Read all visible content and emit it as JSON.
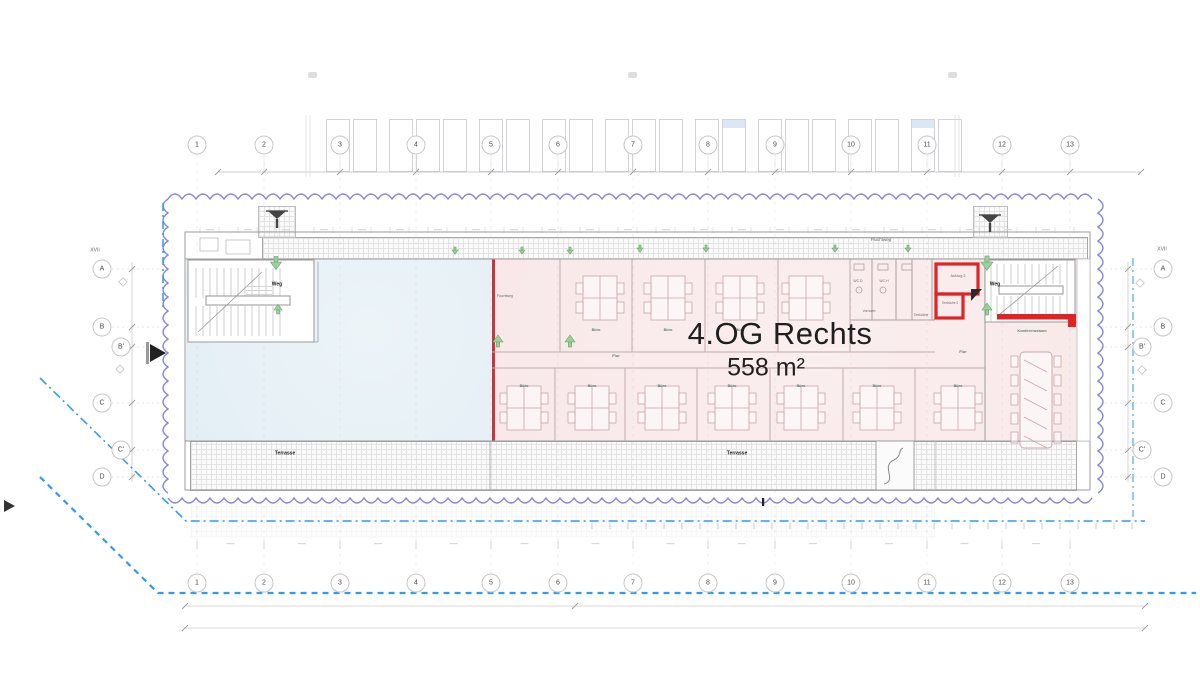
{
  "title": {
    "main": "4.OG Rechts",
    "area": "558 m²"
  },
  "grid": {
    "columns": [
      "1",
      "2",
      "3",
      "4",
      "5",
      "6",
      "7",
      "8",
      "9",
      "10",
      "11",
      "12",
      "13"
    ],
    "rows": [
      {
        "label": "A",
        "y": 269,
        "offset": false
      },
      {
        "label": "B",
        "y": 327,
        "offset": false
      },
      {
        "label": "B'",
        "y": 347,
        "offset": true
      },
      {
        "label": "C",
        "y": 403,
        "offset": false
      },
      {
        "label": "C'",
        "y": 450,
        "offset": true
      },
      {
        "label": "D",
        "y": 477,
        "offset": false
      }
    ],
    "section_label": "XVII"
  },
  "units": {
    "highlighted": {
      "name": "4.OG Rechts",
      "area": "558 m²"
    },
    "other": {
      "name": ""
    }
  },
  "room_labels": [
    {
      "t": "XVII",
      "x": 95,
      "y": 250,
      "s": 5,
      "c": "lg"
    },
    {
      "t": "XVII",
      "x": 1162,
      "y": 249,
      "s": 5,
      "c": "lg"
    },
    {
      "t": "Weg",
      "x": 277,
      "y": 284,
      "s": 5,
      "c": "lb"
    },
    {
      "t": "Weg",
      "x": 995,
      "y": 284,
      "s": 5,
      "c": "lb"
    },
    {
      "t": "Fluchtweg",
      "x": 881,
      "y": 240,
      "s": 4.5,
      "c": "lg"
    },
    {
      "t": "Fluchtweg",
      "x": 505,
      "y": 296,
      "s": 3.5,
      "c": "lg"
    },
    {
      "t": "Aufzug 2",
      "x": 958,
      "y": 276,
      "s": 3.8,
      "c": "lg"
    },
    {
      "t": "Teeküche 2",
      "x": 950,
      "y": 303,
      "s": 3.2,
      "c": "lg"
    },
    {
      "t": "Teeküche",
      "x": 921,
      "y": 315,
      "s": 3.4,
      "c": "lg"
    },
    {
      "t": "Vorraum",
      "x": 869,
      "y": 311,
      "s": 3.4,
      "c": "lg"
    },
    {
      "t": "WC-D",
      "x": 858,
      "y": 281,
      "s": 3.4,
      "c": "lg"
    },
    {
      "t": "WC-H",
      "x": 884,
      "y": 281,
      "s": 3.4,
      "c": "lg"
    },
    {
      "t": "Flur",
      "x": 616,
      "y": 356,
      "s": 4,
      "c": "lt"
    },
    {
      "t": "Flur",
      "x": 963,
      "y": 352,
      "s": 4,
      "c": "lt"
    },
    {
      "t": "Konferenzraum",
      "x": 1032,
      "y": 331,
      "s": 4,
      "c": "lt"
    },
    {
      "t": "Terrasse",
      "x": 285,
      "y": 453,
      "s": 5,
      "c": "lb"
    },
    {
      "t": "Terrasse",
      "x": 737,
      "y": 453,
      "s": 5,
      "c": "lb"
    }
  ],
  "buero": {
    "text": "Büro",
    "top": {
      "y": 330,
      "xs": [
        596,
        668,
        740,
        806
      ]
    },
    "bottom": {
      "y": 386,
      "xs": [
        524,
        592,
        662,
        732,
        801,
        877,
        958
      ]
    }
  },
  "desks": {
    "top": {
      "y": 298,
      "xs": [
        600,
        668,
        740,
        806
      ]
    },
    "bottom": {
      "y": 408,
      "xs": [
        524,
        592,
        662,
        732,
        801,
        877,
        958
      ]
    }
  },
  "green_arrows": {
    "down": [
      [
        276,
        262,
        1.1
      ],
      [
        455,
        250,
        0.6
      ],
      [
        522,
        250,
        0.6
      ],
      [
        570,
        250,
        0.6
      ],
      [
        640,
        248,
        0.6
      ],
      [
        706,
        248,
        0.6
      ],
      [
        835,
        248,
        0.6
      ],
      [
        908,
        248,
        0.6
      ],
      [
        987,
        262,
        1.2
      ]
    ],
    "up": [
      [
        278,
        310,
        0.8
      ],
      [
        498,
        342,
        1.0
      ],
      [
        570,
        342,
        1.0
      ],
      [
        987,
        310,
        1.0
      ]
    ]
  },
  "colors": {
    "highlight_fill": "#f8e8e9",
    "highlight_border": "#c9353a",
    "other_unit_fill": "#e3eef5",
    "envelope_purple": "#7d80d8",
    "boundary_blue": "#2f9bf2",
    "escape_green": "#9ccf9c",
    "core_red": "#de2424"
  }
}
